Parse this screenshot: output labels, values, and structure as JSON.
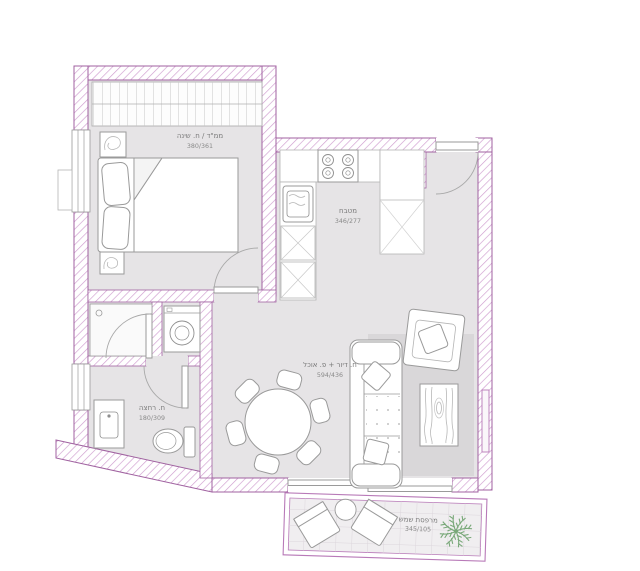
{
  "page": {
    "background": "#ffffff"
  },
  "plan": {
    "colors": {
      "wall_line": "#a062a0",
      "wall_hatch": "#cf9ccf",
      "floor": "#e6e4e6",
      "rug": "#d9d7d9",
      "balcony_floor": "#f0eef0",
      "furniture_line": "#9a9a9a",
      "plant_green": "#79a879",
      "label_text": "#7a7a7a"
    },
    "rooms": {
      "bedroom": {
        "label": "ממ\"ד / ח. שינה",
        "dimensions": "380/361"
      },
      "kitchen": {
        "label": "מטבח",
        "dimensions": "346/277"
      },
      "living_dining": {
        "label": "ח. דיור + פ. אוכל",
        "dimensions": "594/436"
      },
      "bathroom": {
        "label": "ח. רחצה",
        "dimensions": "180/309"
      },
      "balcony": {
        "label": "מרפסת שמש",
        "dimensions": "345/105"
      }
    }
  }
}
